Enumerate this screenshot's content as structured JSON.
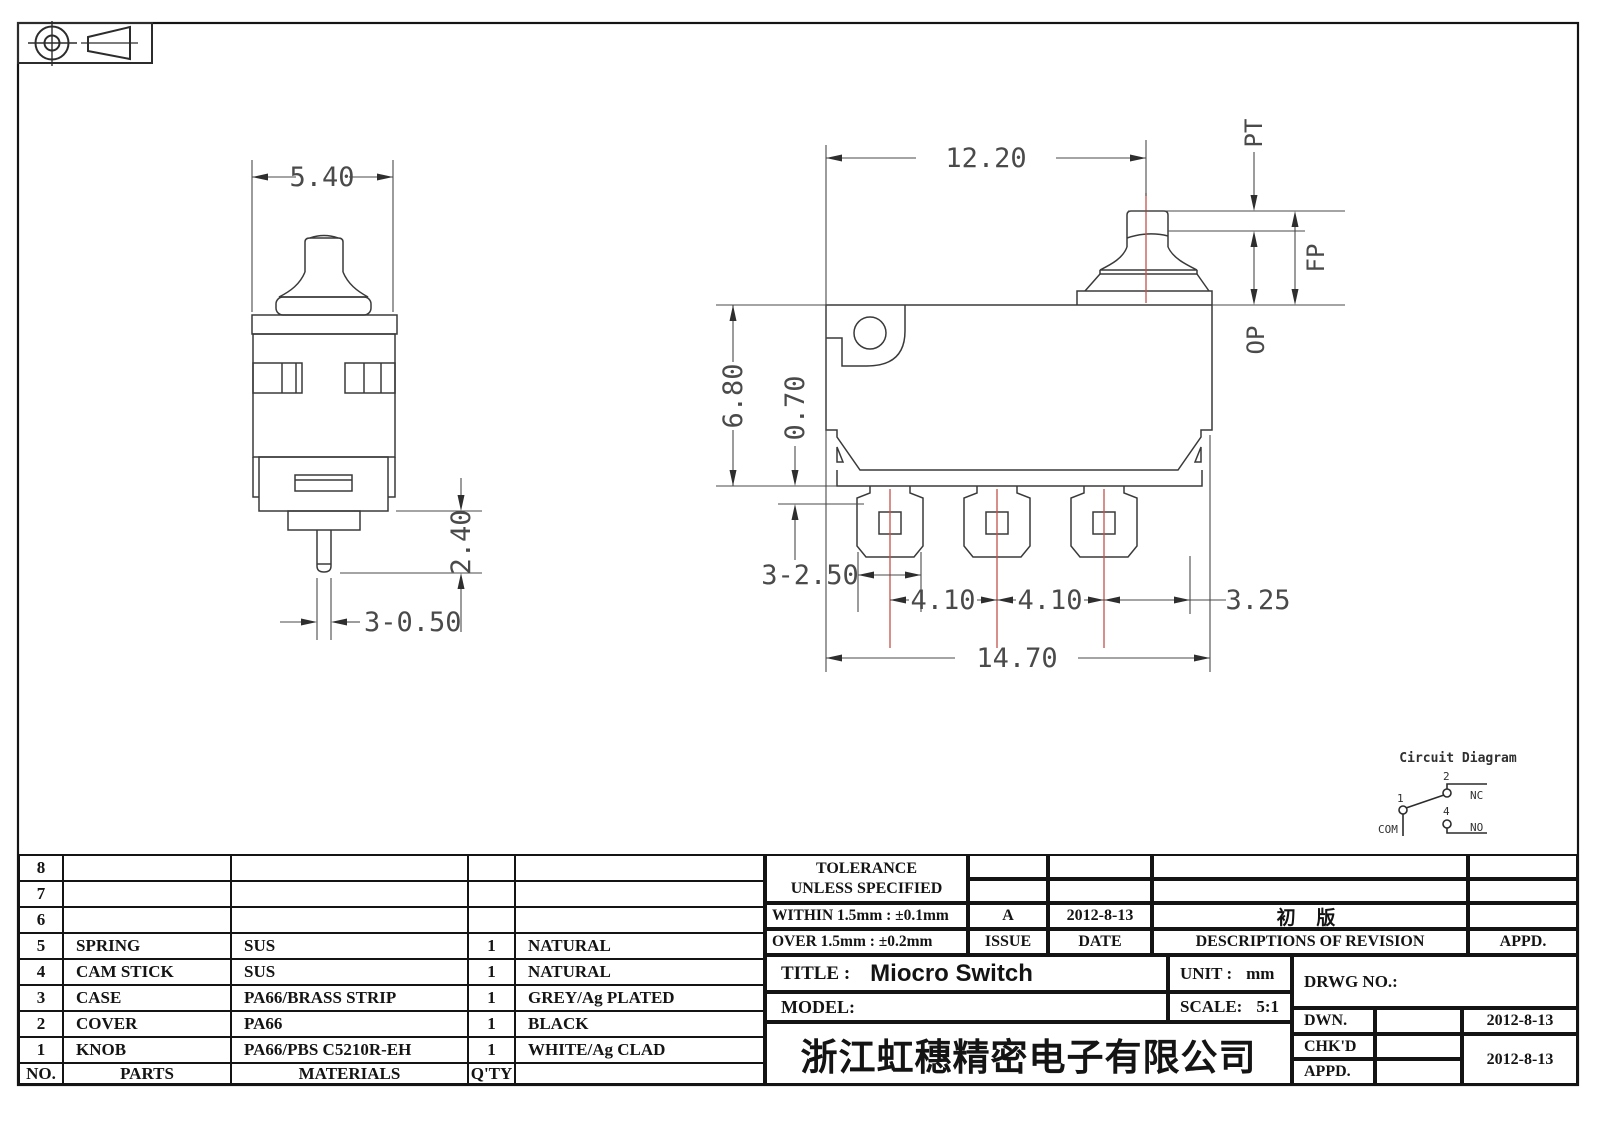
{
  "dimensions": {
    "front_width": "5.40",
    "front_pin_len": "2.40",
    "front_pin_dia": "3-0.50",
    "side_plunger_x": "12.20",
    "side_height": "6.80",
    "side_step": "0.70",
    "pt": "PT",
    "fp": "FP",
    "op": "OP",
    "term_width": "3-2.50",
    "pitch_a": "4.10",
    "pitch_b": "4.10",
    "end_off": "3.25",
    "overall": "14.70"
  },
  "circuit": {
    "title": "Circuit Diagram",
    "com_num": "1",
    "com_label": "COM",
    "nc_num": "2",
    "nc_label": "NC",
    "no_num": "4",
    "no_label": "NO"
  },
  "parts_table": {
    "headers": {
      "no": "NO.",
      "parts": "PARTS",
      "materials": "MATERIALS",
      "qty": "Q'TY",
      "remark": ""
    },
    "rows": [
      {
        "no": "8",
        "parts": "",
        "materials": "",
        "qty": "",
        "remark": ""
      },
      {
        "no": "7",
        "parts": "",
        "materials": "",
        "qty": "",
        "remark": ""
      },
      {
        "no": "6",
        "parts": "",
        "materials": "",
        "qty": "",
        "remark": ""
      },
      {
        "no": "5",
        "parts": "SPRING",
        "materials": "SUS",
        "qty": "1",
        "remark": "NATURAL"
      },
      {
        "no": "4",
        "parts": "CAM STICK",
        "materials": "SUS",
        "qty": "1",
        "remark": "NATURAL"
      },
      {
        "no": "3",
        "parts": "CASE",
        "materials": "PA66/BRASS STRIP",
        "qty": "1",
        "remark": "GREY/Ag PLATED"
      },
      {
        "no": "2",
        "parts": "COVER",
        "materials": "PA66",
        "qty": "1",
        "remark": "BLACK"
      },
      {
        "no": "1",
        "parts": "KNOB",
        "materials": "PA66/PBS C5210R-EH",
        "qty": "1",
        "remark": "WHITE/Ag CLAD"
      }
    ]
  },
  "title_block": {
    "tolerance_line1": "TOLERANCE",
    "tolerance_line2": "UNLESS  SPECIFIED",
    "within": "WITHIN 1.5mm : ±0.1mm",
    "over": "OVER 1.5mm : ±0.2mm",
    "issue_value": "A",
    "issue_date": "2012-8-13",
    "issue_label": "ISSUE",
    "date_label": "DATE",
    "revision_desc": "初 版",
    "revision_label": "DESCRIPTIONS OF REVISION",
    "appd_col_label": "APPD.",
    "title_label": "TITLE :",
    "title_value": "Miocro Switch",
    "unit_label": "UNIT :",
    "unit_value": "mm",
    "drwg_label": "DRWG NO.:",
    "model_label": "MODEL:",
    "scale_label": "SCALE:",
    "scale_value": "5:1",
    "dwn_label": "DWN.",
    "dwn_date": "2012-8-13",
    "chkd_label": "CHK'D",
    "appd_label": "APPD.",
    "chkd_appd_date": "2012-8-13",
    "company": "浙江虹穗精密电子有限公司"
  }
}
